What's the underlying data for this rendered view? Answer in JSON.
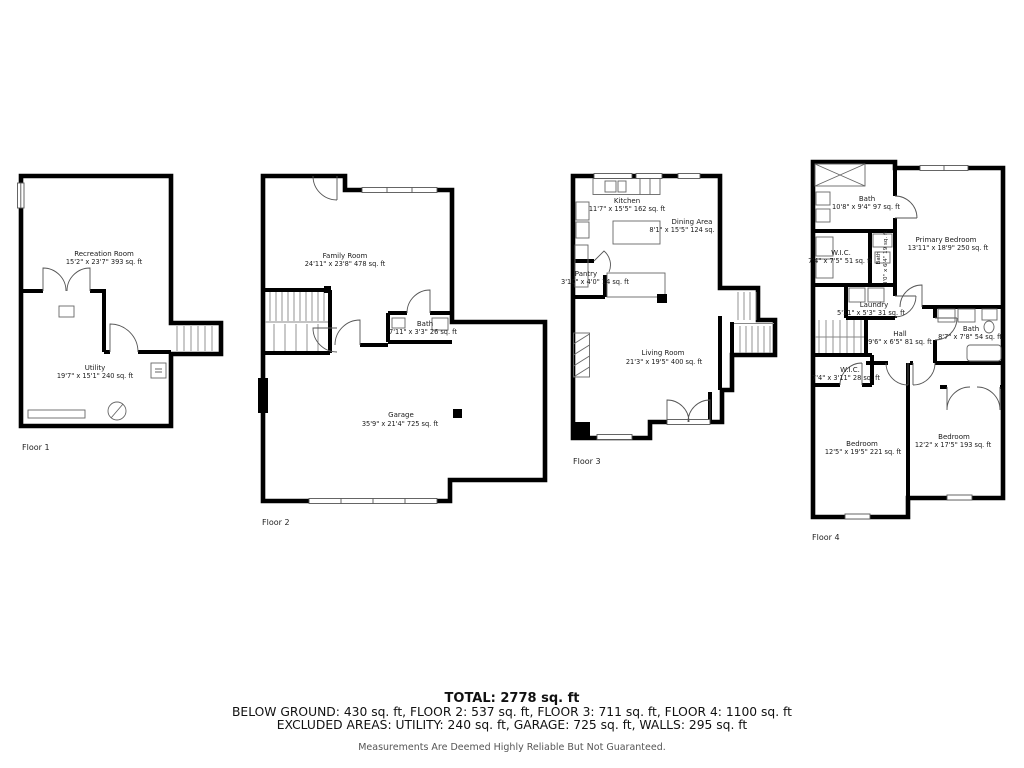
{
  "colors": {
    "wall": "#000000",
    "background": "#ffffff",
    "thin_line": "#666666",
    "disclaimer_text": "#555555"
  },
  "floors": [
    {
      "label": "Floor 1",
      "rooms": [
        {
          "name": "Recreation Room",
          "dims": "15'2\" x 23'7\" 393 sq. ft"
        },
        {
          "name": "Utility",
          "dims": "19'7\" x 15'1\" 240 sq. ft"
        }
      ]
    },
    {
      "label": "Floor 2",
      "rooms": [
        {
          "name": "Family Room",
          "dims": "24'11\" x 23'8\" 478 sq. ft"
        },
        {
          "name": "Bath",
          "dims": "7'11\" x 3'3\" 26 sq. ft"
        },
        {
          "name": "Garage",
          "dims": "35'9\" x 21'4\" 725 sq. ft"
        }
      ]
    },
    {
      "label": "Floor 3",
      "rooms": [
        {
          "name": "Kitchen",
          "dims": "11'7\" x 15'5\" 162 sq. ft"
        },
        {
          "name": "Dining Area",
          "dims": "8'1\" x 15'5\" 124 sq."
        },
        {
          "name": "Pantry",
          "dims": "3'10\" x 4'0\" 14 sq. ft"
        },
        {
          "name": "Living Room",
          "dims": "21'3\" x 19'5\" 400 sq. ft"
        }
      ]
    },
    {
      "label": "Floor 4",
      "rooms": [
        {
          "name": "Bath",
          "dims": "10'8\" x 9'4\" 97 sq. ft"
        },
        {
          "name": "W.I.C.",
          "dims": "7'4\" x 7'5\" 51 sq. ft"
        },
        {
          "name": "Bath",
          "dims": "3'0\" x 6'4\" 19 sq. ft"
        },
        {
          "name": "Primary Bedroom",
          "dims": "13'11\" x 18'9\" 250 sq. ft"
        },
        {
          "name": "Laundry",
          "dims": "5'11\" x 5'3\" 31 sq. ft"
        },
        {
          "name": "Hall",
          "dims": "9'6\" x 6'5\" 81 sq. ft"
        },
        {
          "name": "Bath",
          "dims": "8'7\" x 7'8\" 54 sq. ft"
        },
        {
          "name": "W.I.C.",
          "dims": "7'4\" x 3'11\" 28 sq. ft"
        },
        {
          "name": "Bedroom",
          "dims": "12'5\" x 19'5\" 221 sq. ft"
        },
        {
          "name": "Bedroom",
          "dims": "12'2\" x 17'5\" 193 sq. ft"
        }
      ]
    }
  ],
  "summary": {
    "total": "TOTAL: 2778 sq. ft",
    "floor_areas": "BELOW GROUND: 430 sq. ft, FLOOR 2: 537 sq. ft, FLOOR 3: 711 sq. ft, FLOOR 4: 1100 sq. ft",
    "excluded_areas": "EXCLUDED AREAS: UTILITY: 240 sq. ft, GARAGE: 725 sq. ft, WALLS: 295 sq. ft",
    "disclaimer": "Measurements Are Deemed Highly Reliable But Not Guaranteed."
  }
}
